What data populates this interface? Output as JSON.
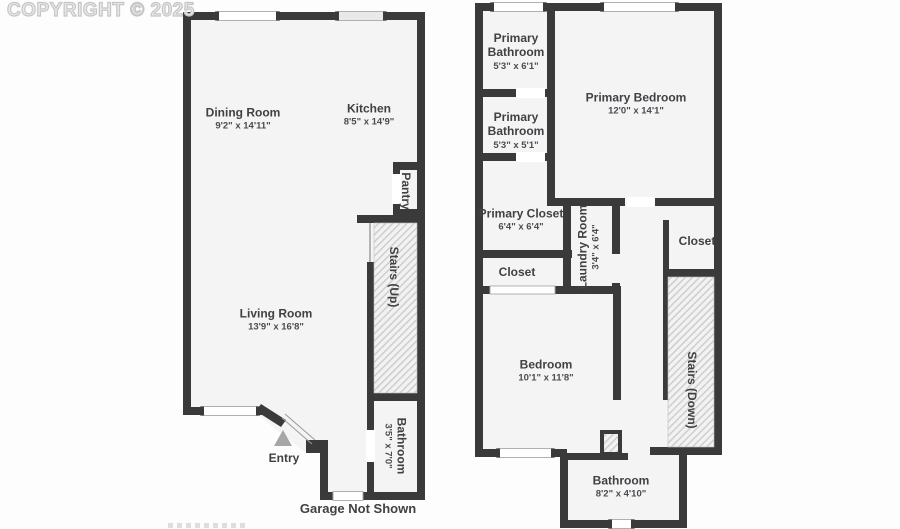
{
  "watermark": {
    "copyright": "COPYRIGHT © 2025"
  },
  "colors": {
    "wall": "#3a3a3a",
    "floor": "#f4f4f4",
    "hatch_line": "#cccccc",
    "label_text": "#3f4144",
    "watermark_gray": "#c6c6c6",
    "entry_arrow": "#a6a6a6"
  },
  "floor1": {
    "rooms": {
      "dining": {
        "name": "Dining Room",
        "dims": "9'2\" x 14'11\""
      },
      "kitchen": {
        "name": "Kitchen",
        "dims": "8'5\" x 14'9\""
      },
      "pantry": {
        "name": "Pantry"
      },
      "stairs_up": {
        "name": "Stairs (Up)"
      },
      "living": {
        "name": "Living Room",
        "dims": "13'9\" x 16'8\""
      },
      "bathroom": {
        "name": "Bathroom",
        "dims": "3'5\" x 7'0\""
      },
      "entry": {
        "name": "Entry"
      },
      "garage_note": "Garage Not Shown"
    }
  },
  "floor2": {
    "rooms": {
      "primary_bathroom_upper": {
        "name_line1": "Primary",
        "name_line2": "Bathroom",
        "dims": "5'3\" x 6'1\""
      },
      "primary_bedroom": {
        "name": "Primary Bedroom",
        "dims": "12'0\" x 14'1\""
      },
      "primary_bathroom_lower": {
        "name_line1": "Primary",
        "name_line2": "Bathroom",
        "dims": "5'3\" x 5'1\""
      },
      "primary_closet": {
        "name": "Primary Closet",
        "dims": "6'4\" x 6'4\""
      },
      "laundry": {
        "name": "Laundry Room",
        "dims": "3'4\" x 6'4\""
      },
      "closet_inner": {
        "name": "Closet"
      },
      "closet_right": {
        "name": "Closet"
      },
      "bedroom": {
        "name": "Bedroom",
        "dims": "10'1\" x 11'8\""
      },
      "stairs_down": {
        "name": "Stairs (Down)"
      },
      "bathroom": {
        "name": "Bathroom",
        "dims": "8'2\" x 4'10\""
      }
    }
  }
}
